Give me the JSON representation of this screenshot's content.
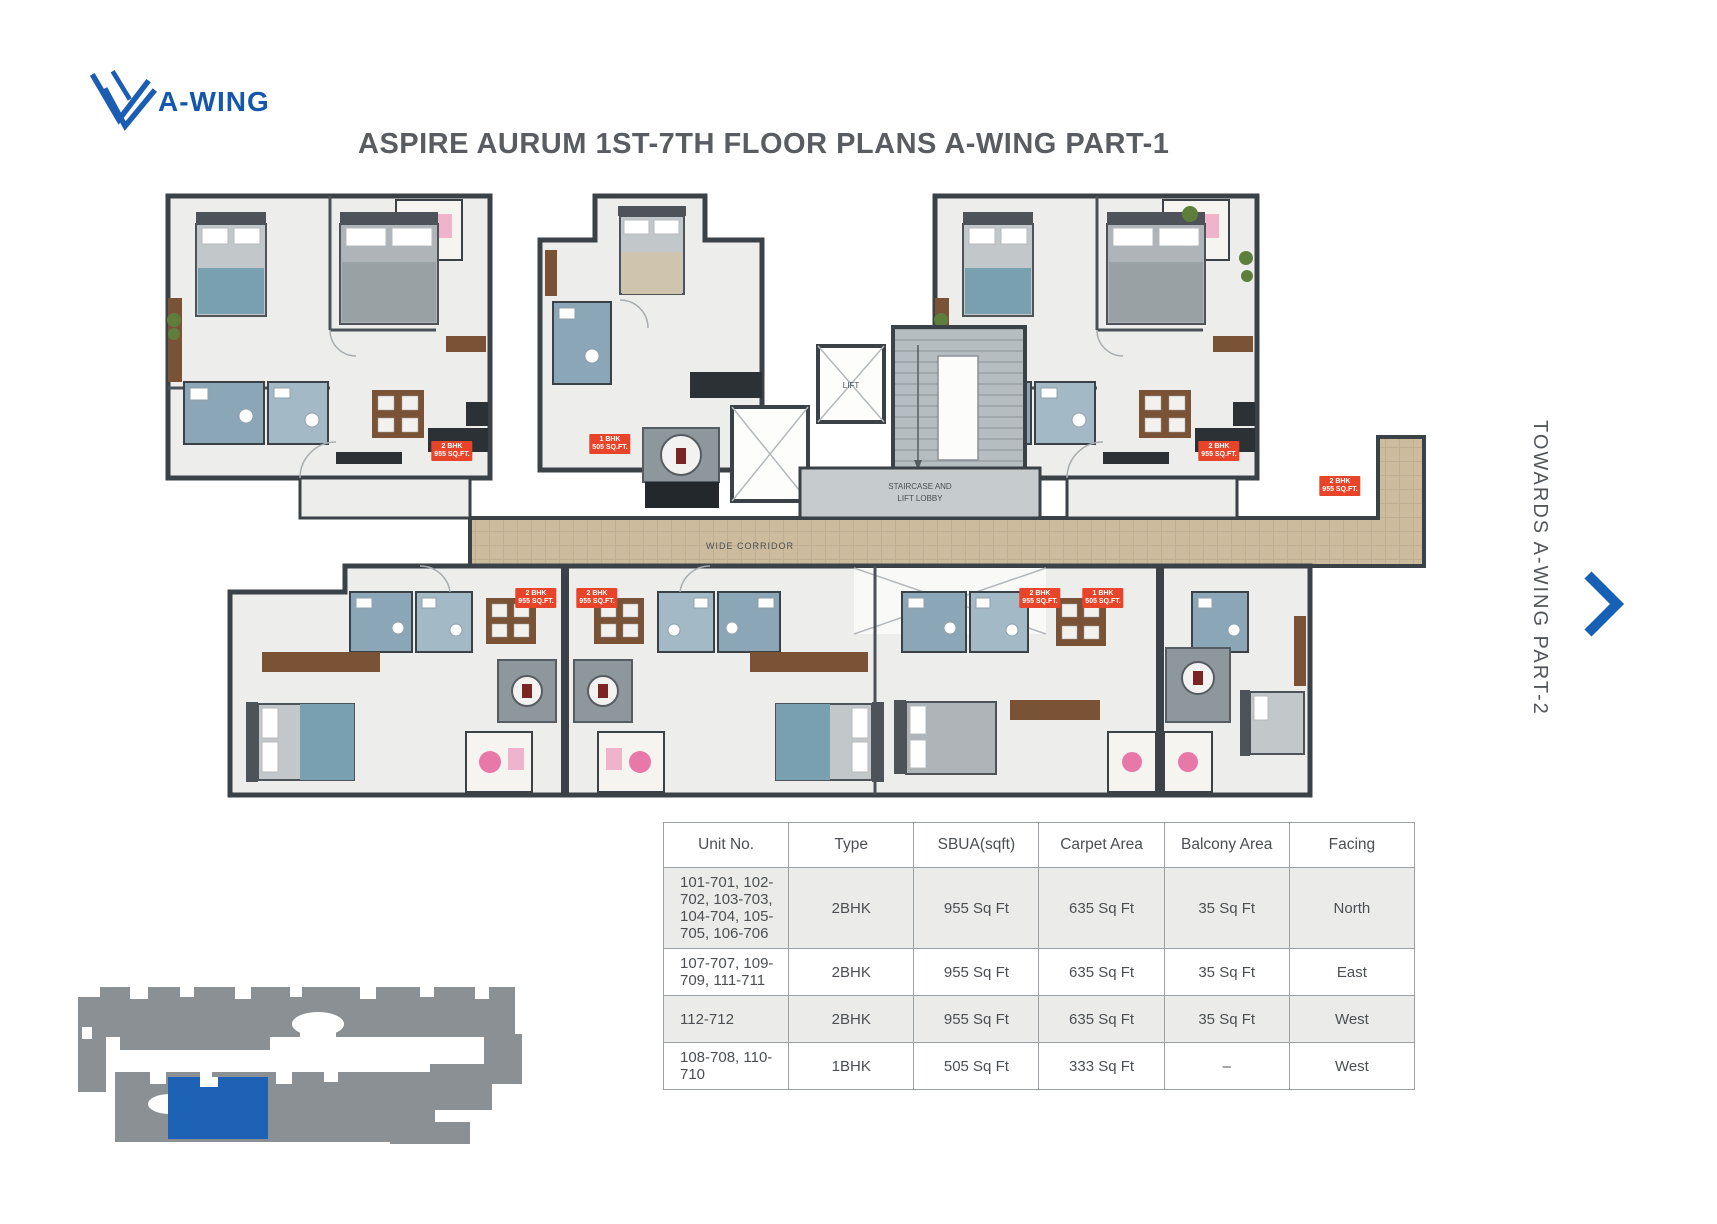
{
  "logo": {
    "label": "A-WING"
  },
  "title": "ASPIRE AURUM 1ST-7TH FLOOR PLANS A-WING PART-1",
  "side_note": {
    "text": "TOWARDS A-WING PART-2"
  },
  "plan": {
    "corridor_label": "WIDE CORRIDOR",
    "lift_label": "LIFT",
    "lobby_label_line1": "STAIRCASE AND",
    "lobby_label_line2": "LIFT LOBBY",
    "unit_labels": [
      {
        "x": 452,
        "y": 441,
        "text": "2 BHK\n955 SQ.FT."
      },
      {
        "x": 610,
        "y": 434,
        "text": "1 BHK\n505 SQ.FT."
      },
      {
        "x": 1219,
        "y": 441,
        "text": "2 BHK\n955 SQ.FT."
      },
      {
        "x": 1340,
        "y": 476,
        "text": "2 BHK\n955 SQ.FT."
      },
      {
        "x": 536,
        "y": 588,
        "text": "2 BHK\n955 SQ.FT."
      },
      {
        "x": 597,
        "y": 588,
        "text": "2 BHK\n955 SQ.FT."
      },
      {
        "x": 1040,
        "y": 588,
        "text": "2 BHK\n955 SQ.FT."
      },
      {
        "x": 1103,
        "y": 588,
        "text": "1 BHK\n505 SQ.FT."
      }
    ]
  },
  "colors": {
    "accent_blue": "#1a5db3",
    "label_red": "#e8442a",
    "keyplan_grey": "#8a9094",
    "keyplan_blue": "#1e62b6",
    "corridor_tan": "#cdbb9e"
  },
  "table": {
    "headers": [
      "Unit No.",
      "Type",
      "SBUA(sqft)",
      "Carpet Area",
      "Balcony Area",
      "Facing"
    ],
    "rows": [
      [
        "101-701, 102-702, 103-703,\n104-704, 105-705, 106-706",
        "2BHK",
        "955 Sq Ft",
        "635 Sq Ft",
        "35 Sq Ft",
        "North"
      ],
      [
        "107-707, 109-709, 111-711",
        "2BHK",
        "955 Sq Ft",
        "635 Sq Ft",
        "35 Sq Ft",
        "East"
      ],
      [
        "112-712",
        "2BHK",
        "955 Sq Ft",
        "635 Sq Ft",
        "35 Sq Ft",
        "West"
      ],
      [
        "108-708, 110-710",
        "1BHK",
        "505 Sq Ft",
        "333 Sq Ft",
        "–",
        "West"
      ]
    ]
  }
}
